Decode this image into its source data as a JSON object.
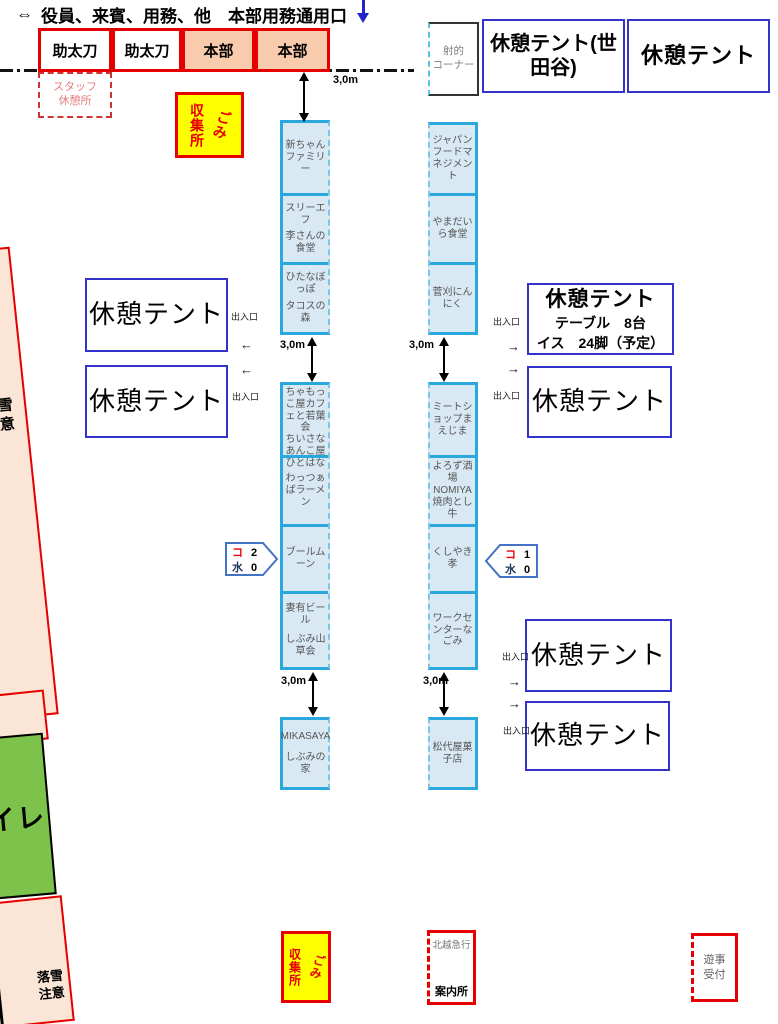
{
  "header": {
    "arrow": "⇔",
    "title": "役員、来賓、用務、他　本部用務通用口"
  },
  "distance_label": "3,0m",
  "entrance_label": "出入口",
  "arrow_left": "←",
  "arrow_right": "→",
  "hq": {
    "boxes": [
      {
        "label": "助太刀"
      },
      {
        "label": "助太刀"
      },
      {
        "label": "本部"
      },
      {
        "label": "本部"
      }
    ]
  },
  "staff_rest": {
    "line1": "スタッフ",
    "line2": "休憩所"
  },
  "shooting": {
    "line1": "射的",
    "line2": "コーナー"
  },
  "trash": {
    "left_vertical": "収集所",
    "right_vertical": "ごみ"
  },
  "tents": {
    "setagaya": "休憩テント(世田谷)",
    "top_right": "休憩テント",
    "left_upper": "休憩テント",
    "left_lower": "休憩テント",
    "mid_right_upper": {
      "title": "休憩テント",
      "line2": "テーブル　8台",
      "line3": "イス　24脚（予定）"
    },
    "mid_right_lower": "休憩テント",
    "bottom_right_upper": "休憩テント",
    "bottom_right_lower": "休憩テント"
  },
  "booths": {
    "left": {
      "group1": {
        "c1": [
          "新ちゃんファミリー"
        ],
        "c2": [
          "スリーエフ",
          "李さんの食堂"
        ],
        "c3": [
          "ひたなぼっぽ",
          "タコスの森"
        ]
      },
      "group2": {
        "c1": [
          "ちゃもっこ屋カフェと若葉会",
          "ちいさなあんこ屋ひとはな"
        ],
        "c2": [
          "わっつぁばラーメン"
        ],
        "c3": [
          "ブールムーン"
        ],
        "c4": [
          "妻有ビール",
          "しぶみ山草会"
        ]
      },
      "group3": {
        "c1": [
          "MIKASAYA",
          "しぶみの家"
        ]
      }
    },
    "right": {
      "group1": {
        "c1": [
          "ジャパンフードマネジメント"
        ],
        "c2": [
          "やまだいら食堂"
        ],
        "c3": [
          "菅刈にんにく"
        ]
      },
      "group2": {
        "c1": [
          "ミートショップまえじま"
        ],
        "c2": [
          "よろず酒場NOMIYA",
          "焼肉とし牛"
        ],
        "c3": [
          "くしやき孝"
        ],
        "c4": [
          "ワークセンターなごみ"
        ]
      },
      "group3": {
        "c1": [
          "松代屋菓子店"
        ]
      }
    }
  },
  "callouts": {
    "left": {
      "r1_label": "コ",
      "r1_value": "2",
      "r2_label": "水",
      "r2_value": "0"
    },
    "right": {
      "r1_label": "コ",
      "r1_value": "1",
      "r2_label": "水",
      "r2_value": "0"
    }
  },
  "bottom": {
    "info": {
      "operator": "北越急行",
      "label": "案内所"
    },
    "reception": {
      "line1": "遊事",
      "line2": "受付"
    }
  },
  "strips": {
    "toilet": "トイレ",
    "snow_warning_line1": "落雪",
    "snow_warning_line2": "注意"
  },
  "colors": {
    "red_border": "#e60000",
    "peach": "#f8cbad",
    "strip_peach": "#fbe5d6",
    "yellow": "#ffff00",
    "booth_fill": "#d9e9f4",
    "booth_border": "#2aa7dc",
    "tent_border": "#3333cc",
    "green": "#7cc24b",
    "gray_text": "#808080",
    "pink_text": "#e57f7f",
    "callout_ko": "#e60000",
    "callout_mizu": "#1f3864",
    "blue_arrow": "#2323cc"
  }
}
